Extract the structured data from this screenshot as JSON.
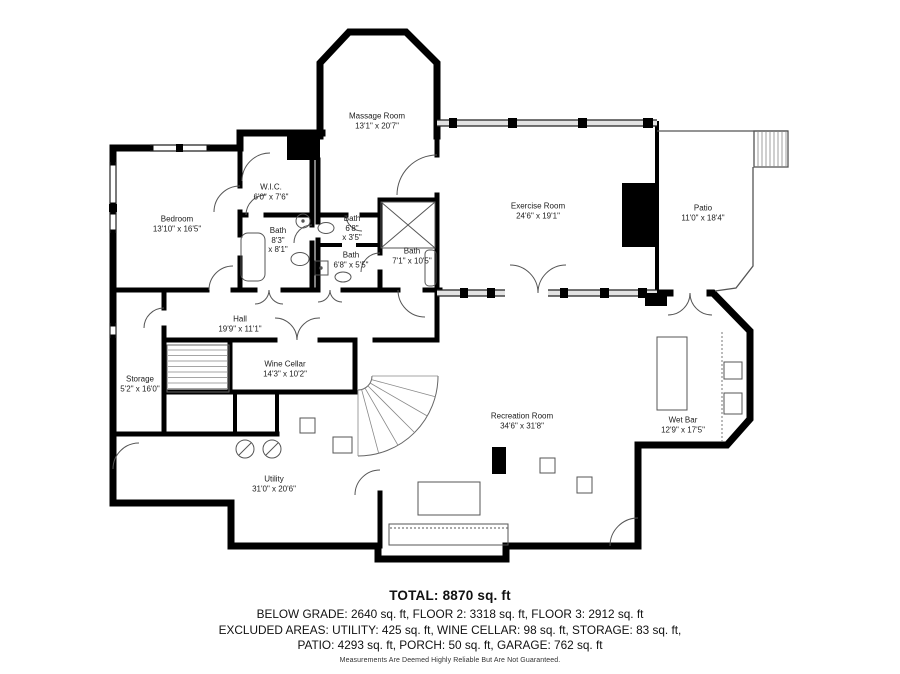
{
  "plan": {
    "wall_color": "#000000",
    "background": "#ffffff",
    "rooms": [
      {
        "id": "massage-room",
        "name": "Massage Room",
        "dims": "13'1\" x 20'7\""
      },
      {
        "id": "wic",
        "name": "W.I.C.",
        "dims": "6'0\" x 7'6\""
      },
      {
        "id": "bedroom",
        "name": "Bedroom",
        "dims": "13'10\" x 16'5\""
      },
      {
        "id": "bath-1",
        "name": "Bath",
        "dims": "8'3\"",
        "dims2": "x 8'1\""
      },
      {
        "id": "bath-2",
        "name": "Bath",
        "dims": "6'8\"",
        "dims2": "x 3'5\""
      },
      {
        "id": "bath-3",
        "name": "Bath",
        "dims": "6'8\" x 5'5\""
      },
      {
        "id": "bath-4",
        "name": "Bath",
        "dims": "7'1\" x 10'5\""
      },
      {
        "id": "exercise-room",
        "name": "Exercise Room",
        "dims": "24'6\" x 19'1\""
      },
      {
        "id": "patio",
        "name": "Patio",
        "dims": "11'0\" x 18'4\""
      },
      {
        "id": "hall",
        "name": "Hall",
        "dims": "19'9\" x 11'1\""
      },
      {
        "id": "wine-cellar",
        "name": "Wine Cellar",
        "dims": "14'3\" x 10'2\""
      },
      {
        "id": "storage",
        "name": "Storage",
        "dims": "5'2\" x 16'0\""
      },
      {
        "id": "recreation-room",
        "name": "Recreation Room",
        "dims": "34'6\" x 31'8\""
      },
      {
        "id": "wet-bar",
        "name": "Wet Bar",
        "dims": "12'9\" x 17'5\""
      },
      {
        "id": "utility",
        "name": "Utility",
        "dims": "31'0\" x 20'6\""
      }
    ]
  },
  "summary": {
    "total": "TOTAL: 8870 sq. ft",
    "line1": "BELOW GRADE: 2640 sq. ft, FLOOR 2: 3318 sq. ft, FLOOR 3: 2912 sq. ft",
    "line2": "EXCLUDED AREAS: UTILITY: 425 sq. ft, WINE CELLAR: 98 sq. ft, STORAGE: 83 sq. ft,",
    "line3": "PATIO: 4293 sq. ft, PORCH: 50 sq. ft, GARAGE: 762 sq. ft",
    "disclaimer": "Measurements Are Deemed Highly Reliable But Are Not Guaranteed."
  }
}
